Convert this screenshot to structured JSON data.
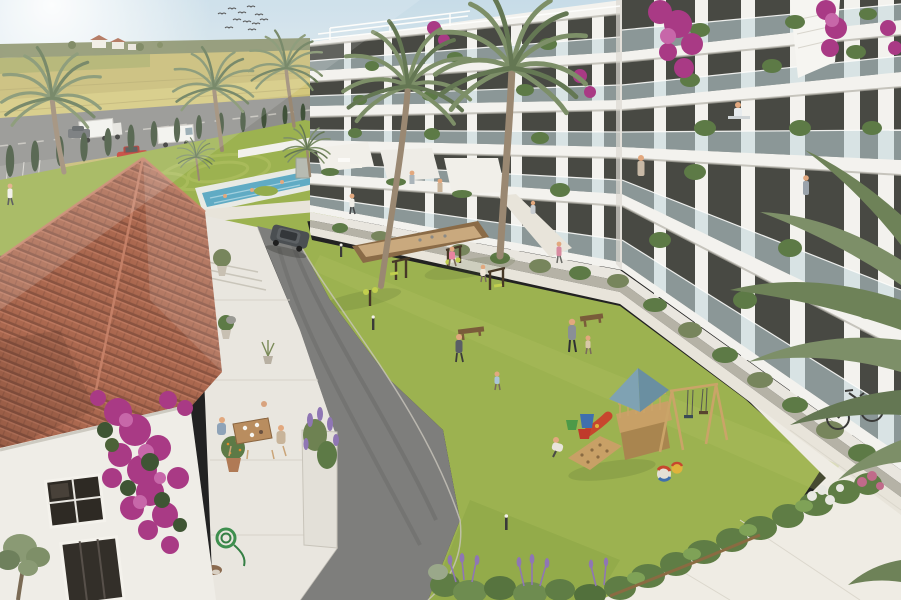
{
  "meta": {
    "description": "Aerial 3D render of a Mediterranean apartment complex: white balconied block, courtyard lawn with playground and outdoor gym, lap pool, old terracotta-roof house with bougainvillea and dining terrace, wheat fields and highway behind",
    "birds_count": 11,
    "palm_count": 7,
    "floors_visible": 5
  },
  "palette": {
    "sky_top": "#c7dce8",
    "sky_horizon": "#eef3ee",
    "sun_glow": "#ffffff",
    "field_wheat": "#c6ba72",
    "field_light": "#d6ca7e",
    "field_green": "#9da661",
    "tree_line": "#7a8154",
    "cypress": "#41523a",
    "highway": "#8f8f8b",
    "road": "#7e7e7c",
    "road_dark": "#686866",
    "path": "#e8e4da",
    "pavement": "#efece4",
    "lawn": "#9cb250",
    "lawn_light": "#b4c464",
    "lawn_dark": "#7f9a3e",
    "pool_water": "#60abc4",
    "pool_deck": "#e8eae4",
    "building_wall": "#f3f2ee",
    "building_shade": "#dbd9d2",
    "slab_shadow": "#b3b1a8",
    "window_glass": "#3a3b35",
    "balcony_glass": "#c3d7dc",
    "roof_tile": "#ab684f",
    "roof_tile_dark": "#8a5340",
    "roof_tile_light": "#c8836a",
    "terrace_stone": "#e9e6df",
    "bougainvillea": "#a93a85",
    "bougainvillea_light": "#c767a9",
    "plant_green": "#5d7a46",
    "olive_green": "#77855c",
    "palm_frond": "#7d8f68",
    "palm_trunk": "#9a8872",
    "play_wood": "#c8a066",
    "play_wood_dark": "#a9854f",
    "play_roof": "#7fa2b3",
    "slide_red": "#c7472e",
    "sand": "#c9a97e",
    "lavender": "#8f76b4",
    "hedge_green": "#5f7d45",
    "hose_green": "#3e8f4e",
    "table_wood": "#b98d5f",
    "suv_body": "#4b4f52",
    "car_red": "#c23a2e",
    "truck_white": "#f2f1ed"
  }
}
